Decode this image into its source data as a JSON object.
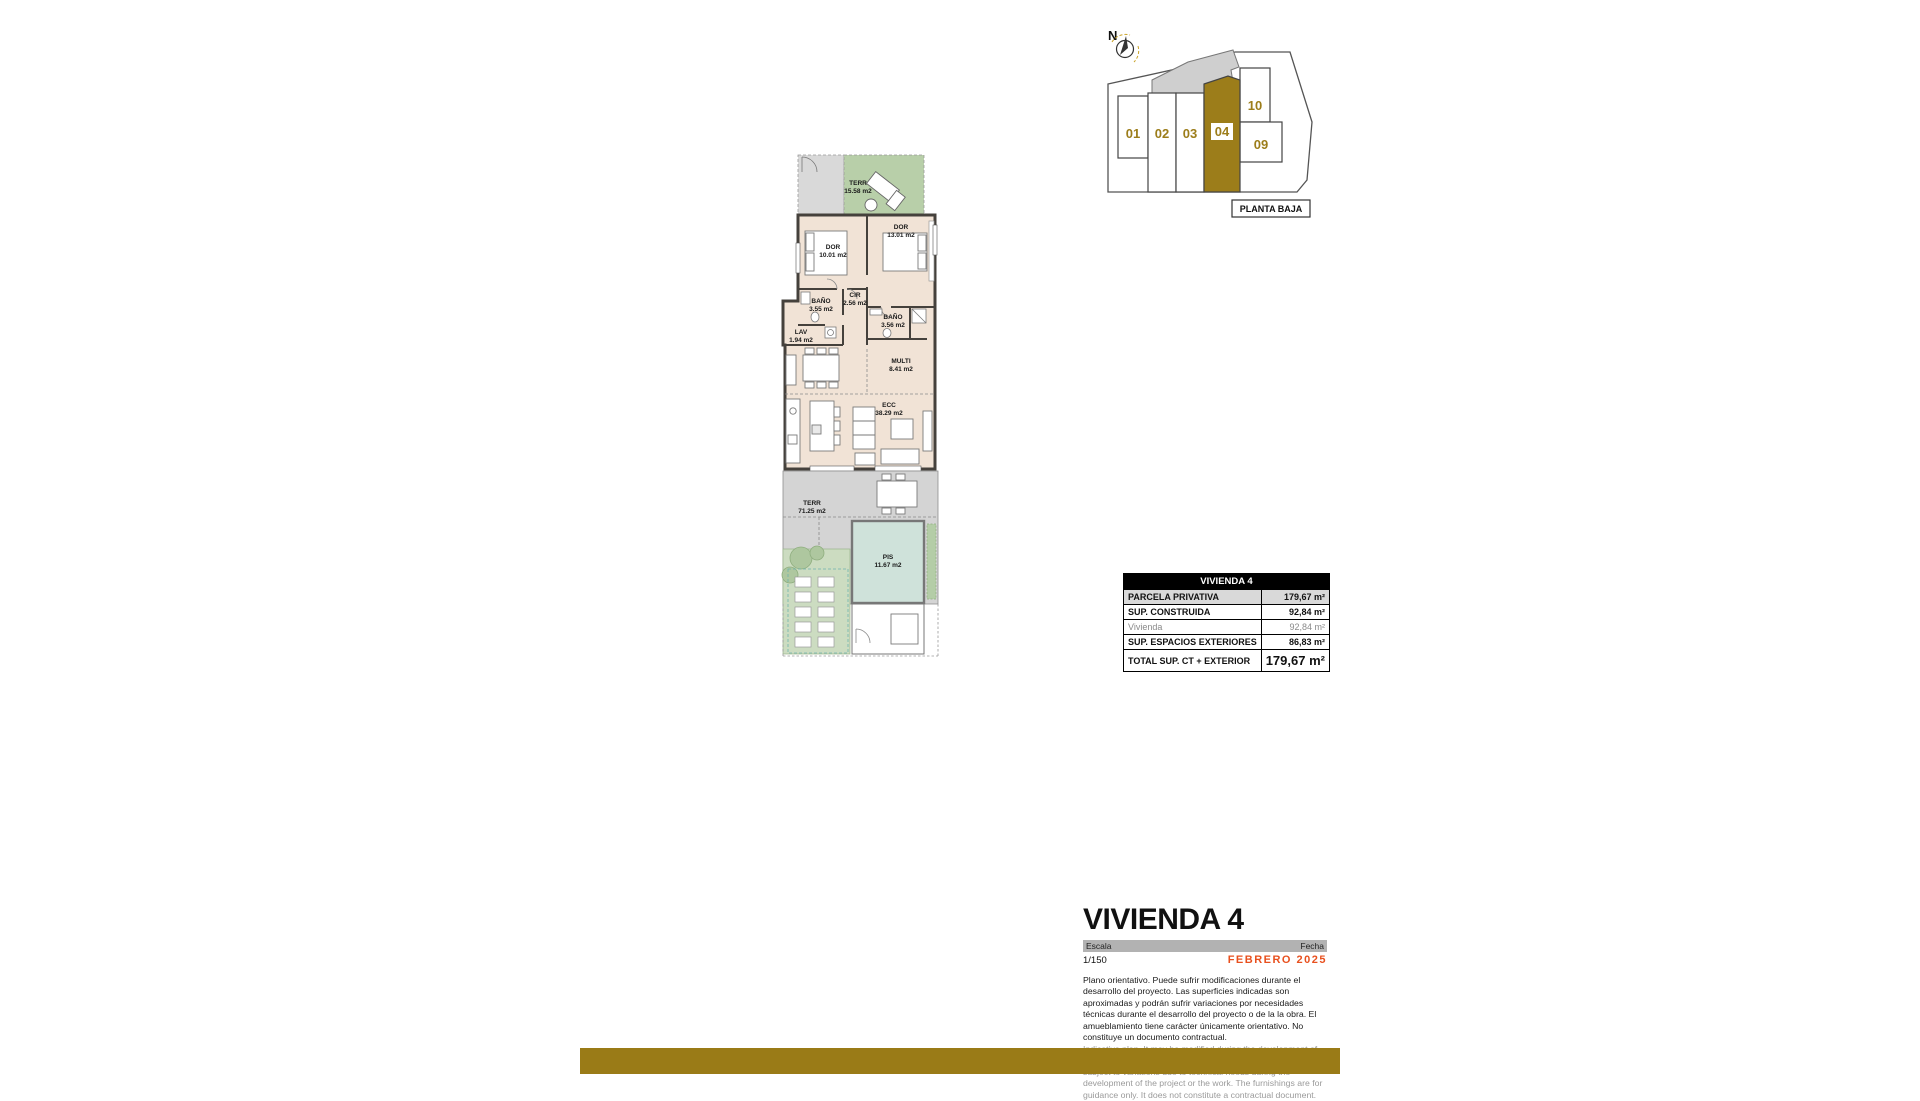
{
  "site_plan": {
    "north_label": "N",
    "floor_label": "PLANTA BAJA",
    "highlighted_unit": "04",
    "units": [
      "01",
      "02",
      "03",
      "04",
      "09",
      "10"
    ]
  },
  "floor_plan": {
    "rooms": [
      {
        "name": "TERR",
        "area": "15.58 m2"
      },
      {
        "name": "DOR",
        "area": "10.01 m2"
      },
      {
        "name": "DOR",
        "area": "13.01 m2"
      },
      {
        "name": "BAÑO",
        "area": "3.55 m2"
      },
      {
        "name": "CIR",
        "area": "2.56 m2"
      },
      {
        "name": "BAÑO",
        "area": "3.56 m2"
      },
      {
        "name": "LAV",
        "area": "1.94 m2"
      },
      {
        "name": "MULTI",
        "area": "8.41 m2"
      },
      {
        "name": "ECC",
        "area": "38.29 m2"
      },
      {
        "name": "TERR",
        "area": "71.25 m2"
      },
      {
        "name": "PIS",
        "area": "11.67 m2"
      }
    ]
  },
  "summary_table": {
    "header": "VIVIENDA 4",
    "rows": [
      {
        "label": "PARCELA PRIVATIVA",
        "value": "179,67 m²"
      },
      {
        "label": "SUP. CONSTRUIDA",
        "value": "92,84 m²"
      },
      {
        "label": "Vivienda",
        "value": "92,84 m²"
      },
      {
        "label": "SUP. ESPACIOS EXTERIORES",
        "value": "86,83 m²"
      },
      {
        "label": "TOTAL SUP. CT + EXTERIOR",
        "value": "179,67 m²"
      }
    ]
  },
  "title_block": {
    "title": "VIVIENDA 4",
    "scale_label": "Escala",
    "scale_value": "1/150",
    "date_label": "Fecha",
    "date_value": "FEBRERO 2025",
    "disclaimer_es": "Plano orientativo. Puede sufrir modificaciones durante el desarrollo del proyecto. Las superficies indicadas son aproximadas y podrán sufrir variaciones por necesidades técnicas durante el desarrollo del proyecto o de la la obra. El amueblamiento tiene carácter únicamente orientativo. No constituye un documento contractual.",
    "disclaimer_en": "Indicative plan. It may be modified during the development of the project. The areas indicated are approximate and may be subject to variations due to technical needs during the development of the project or the work. The furnishings are for guidance only. It does not constitute a contractual document."
  },
  "colors": {
    "accent_gold": "#9a7b17",
    "date_orange": "#e8501e",
    "terrace_green": "#b8cfa9",
    "interior_beige": "#f1e3d6",
    "pool_teal": "#cfe2da",
    "terrace_gray": "#d4d4d4"
  }
}
